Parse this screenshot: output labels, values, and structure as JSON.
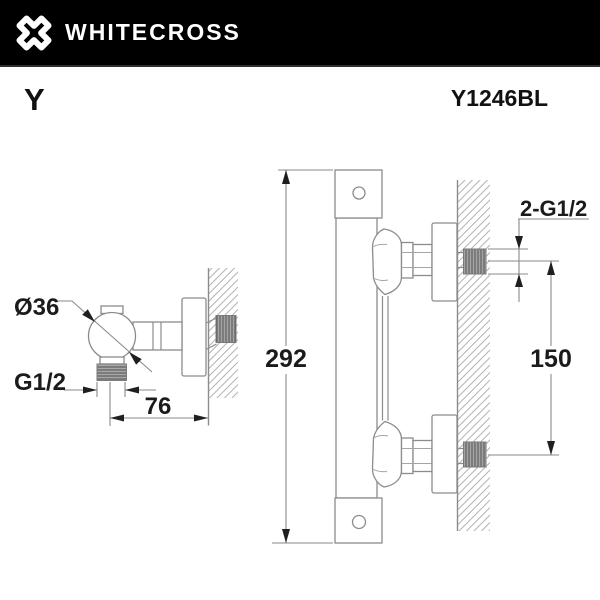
{
  "header": {
    "brand": "WHITECROSS"
  },
  "product": {
    "series": "Y",
    "code": "Y1246BL"
  },
  "colors": {
    "header_bg": "#000000",
    "drawing_line": "#8c8c8c",
    "dimension_text": "#1b1b1b",
    "hatch_line": "#b4b4b4",
    "thread_fill": "#a3a3a3"
  },
  "drawings": {
    "side_view": {
      "description": "shower outlet elbow side view",
      "labels": {
        "diameter": "Ø36",
        "outlet_thread": "G1/2",
        "wall_distance": "76"
      }
    },
    "front_view": {
      "description": "thermostatic mixer profile view on wall",
      "labels": {
        "overall_height": "292",
        "connection_spacing": "150",
        "connection_thread": "2-G1/2"
      }
    }
  }
}
